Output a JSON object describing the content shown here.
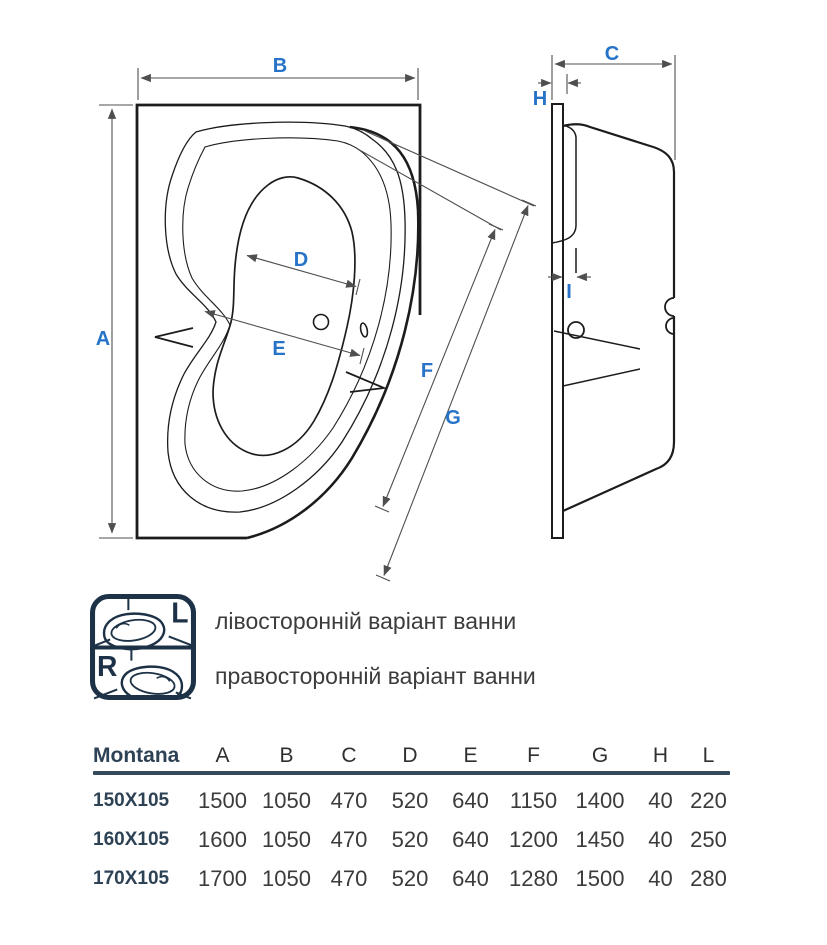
{
  "colors": {
    "accent_blue": "#2673c8",
    "icon_navy": "#1d3246",
    "table_navy": "#2d4254",
    "rule_navy": "#34495a",
    "drawing_line": "#1c1c1c",
    "dimension_line": "#4f4f4f",
    "body_text": "#3c3c3c"
  },
  "dimension_labels": {
    "top_view": {
      "a": "A",
      "b": "B",
      "d": "D",
      "e": "E",
      "f": "F",
      "g": "G"
    },
    "side_view": {
      "c": "C",
      "h": "H",
      "i": "I"
    }
  },
  "variants": {
    "left_letter": "L",
    "right_letter": "R",
    "left_text": "лівосторонній варіант ванни",
    "right_text": "правосторонній варіант ванни"
  },
  "table": {
    "title": "Montana",
    "columns": [
      "A",
      "B",
      "C",
      "D",
      "E",
      "F",
      "G",
      "H",
      "L"
    ],
    "rows": [
      {
        "label": "150X105",
        "values": [
          "1500",
          "1050",
          "470",
          "520",
          "640",
          "1150",
          "1400",
          "40",
          "220"
        ]
      },
      {
        "label": "160X105",
        "values": [
          "1600",
          "1050",
          "470",
          "520",
          "640",
          "1200",
          "1450",
          "40",
          "250"
        ]
      },
      {
        "label": "170X105",
        "values": [
          "1700",
          "1050",
          "470",
          "520",
          "640",
          "1280",
          "1500",
          "40",
          "280"
        ]
      }
    ]
  }
}
